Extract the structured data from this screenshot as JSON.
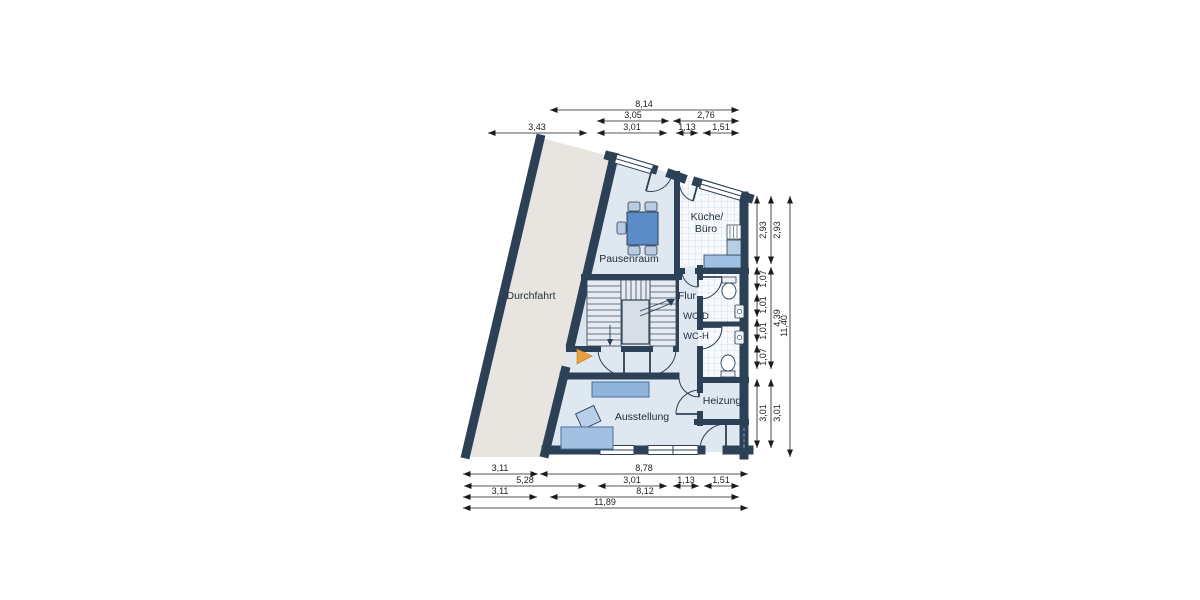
{
  "plan": {
    "type": "floor-plan",
    "rooms": {
      "durchfahrt": {
        "label": "Durchfahrt"
      },
      "pausenraum": {
        "label": "Pausenraum"
      },
      "kueche": {
        "line1": "Küche/",
        "line2": "Büro"
      },
      "flur": {
        "label": "Flur"
      },
      "wc_d": {
        "label": "WC-D"
      },
      "wc_h": {
        "label": "WC-H"
      },
      "heizung": {
        "label": "Heizung"
      },
      "ausstellung": {
        "label": "Ausstellung"
      }
    },
    "fixtures": [
      "stairs",
      "elevator-shaft",
      "table-with-chairs",
      "kitchen-counter",
      "stove",
      "toilet",
      "sink",
      "sideboard",
      "display-table",
      "entrance-arrow"
    ]
  },
  "dimensions": {
    "top": [
      {
        "label": "8,14"
      },
      {
        "label": "3,05"
      },
      {
        "label": "2,76"
      },
      {
        "label": "3,43"
      },
      {
        "label": "3,01"
      },
      {
        "label": "1,13"
      },
      {
        "label": "1,51"
      }
    ],
    "bottom": [
      {
        "label": "3,11"
      },
      {
        "label": "8,78"
      },
      {
        "label": "5,28"
      },
      {
        "label": "3,01"
      },
      {
        "label": "1,13"
      },
      {
        "label": "1,51"
      },
      {
        "label": "3,11"
      },
      {
        "label": "8,12"
      },
      {
        "label": "11,89"
      }
    ],
    "right": [
      {
        "label": "2,93"
      },
      {
        "label": "1,07"
      },
      {
        "label": "1,01"
      },
      {
        "label": "1,01"
      },
      {
        "label": "1,07"
      },
      {
        "label": "3,01"
      },
      {
        "label": "2,93"
      },
      {
        "label": "4,39"
      },
      {
        "label": "3,01"
      },
      {
        "label": "11,40"
      }
    ]
  },
  "colors": {
    "wall": "#2d4156",
    "room_floor": "#dfe7f1",
    "driveway_floor": "#e8e5e0",
    "tile_floor": "#f8fafd",
    "tile_grid": "#c9d9ea",
    "furniture_blue": "#5c8cc6",
    "furniture_light": "#a3c0e0",
    "entrance_arrow": "#eaa13c",
    "dimension_ink": "#1c1c1c"
  }
}
